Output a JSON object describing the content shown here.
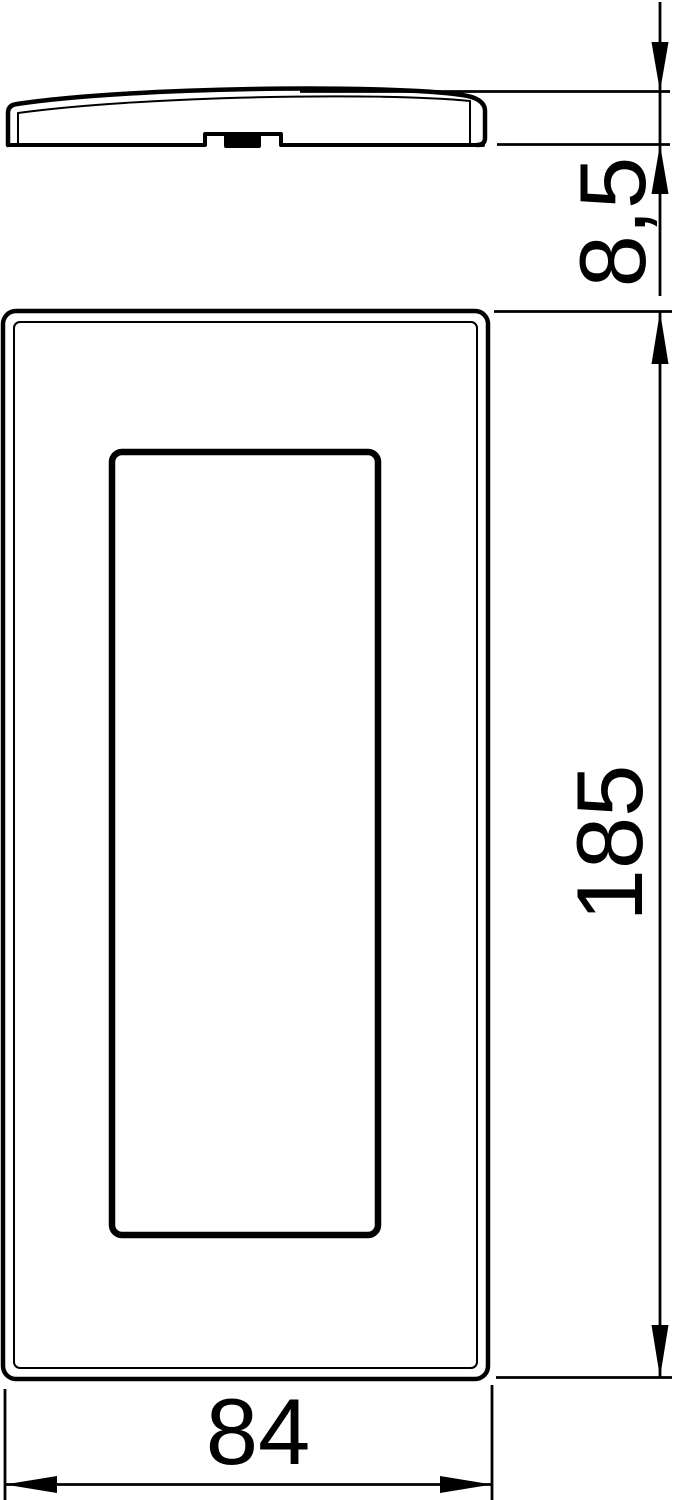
{
  "drawing": {
    "type": "technical-dimension-drawing",
    "colors": {
      "line": "#000000",
      "background": "#ffffff"
    },
    "labels": {
      "profile_height": "8,5",
      "front_height": "185",
      "front_width": "84"
    }
  }
}
